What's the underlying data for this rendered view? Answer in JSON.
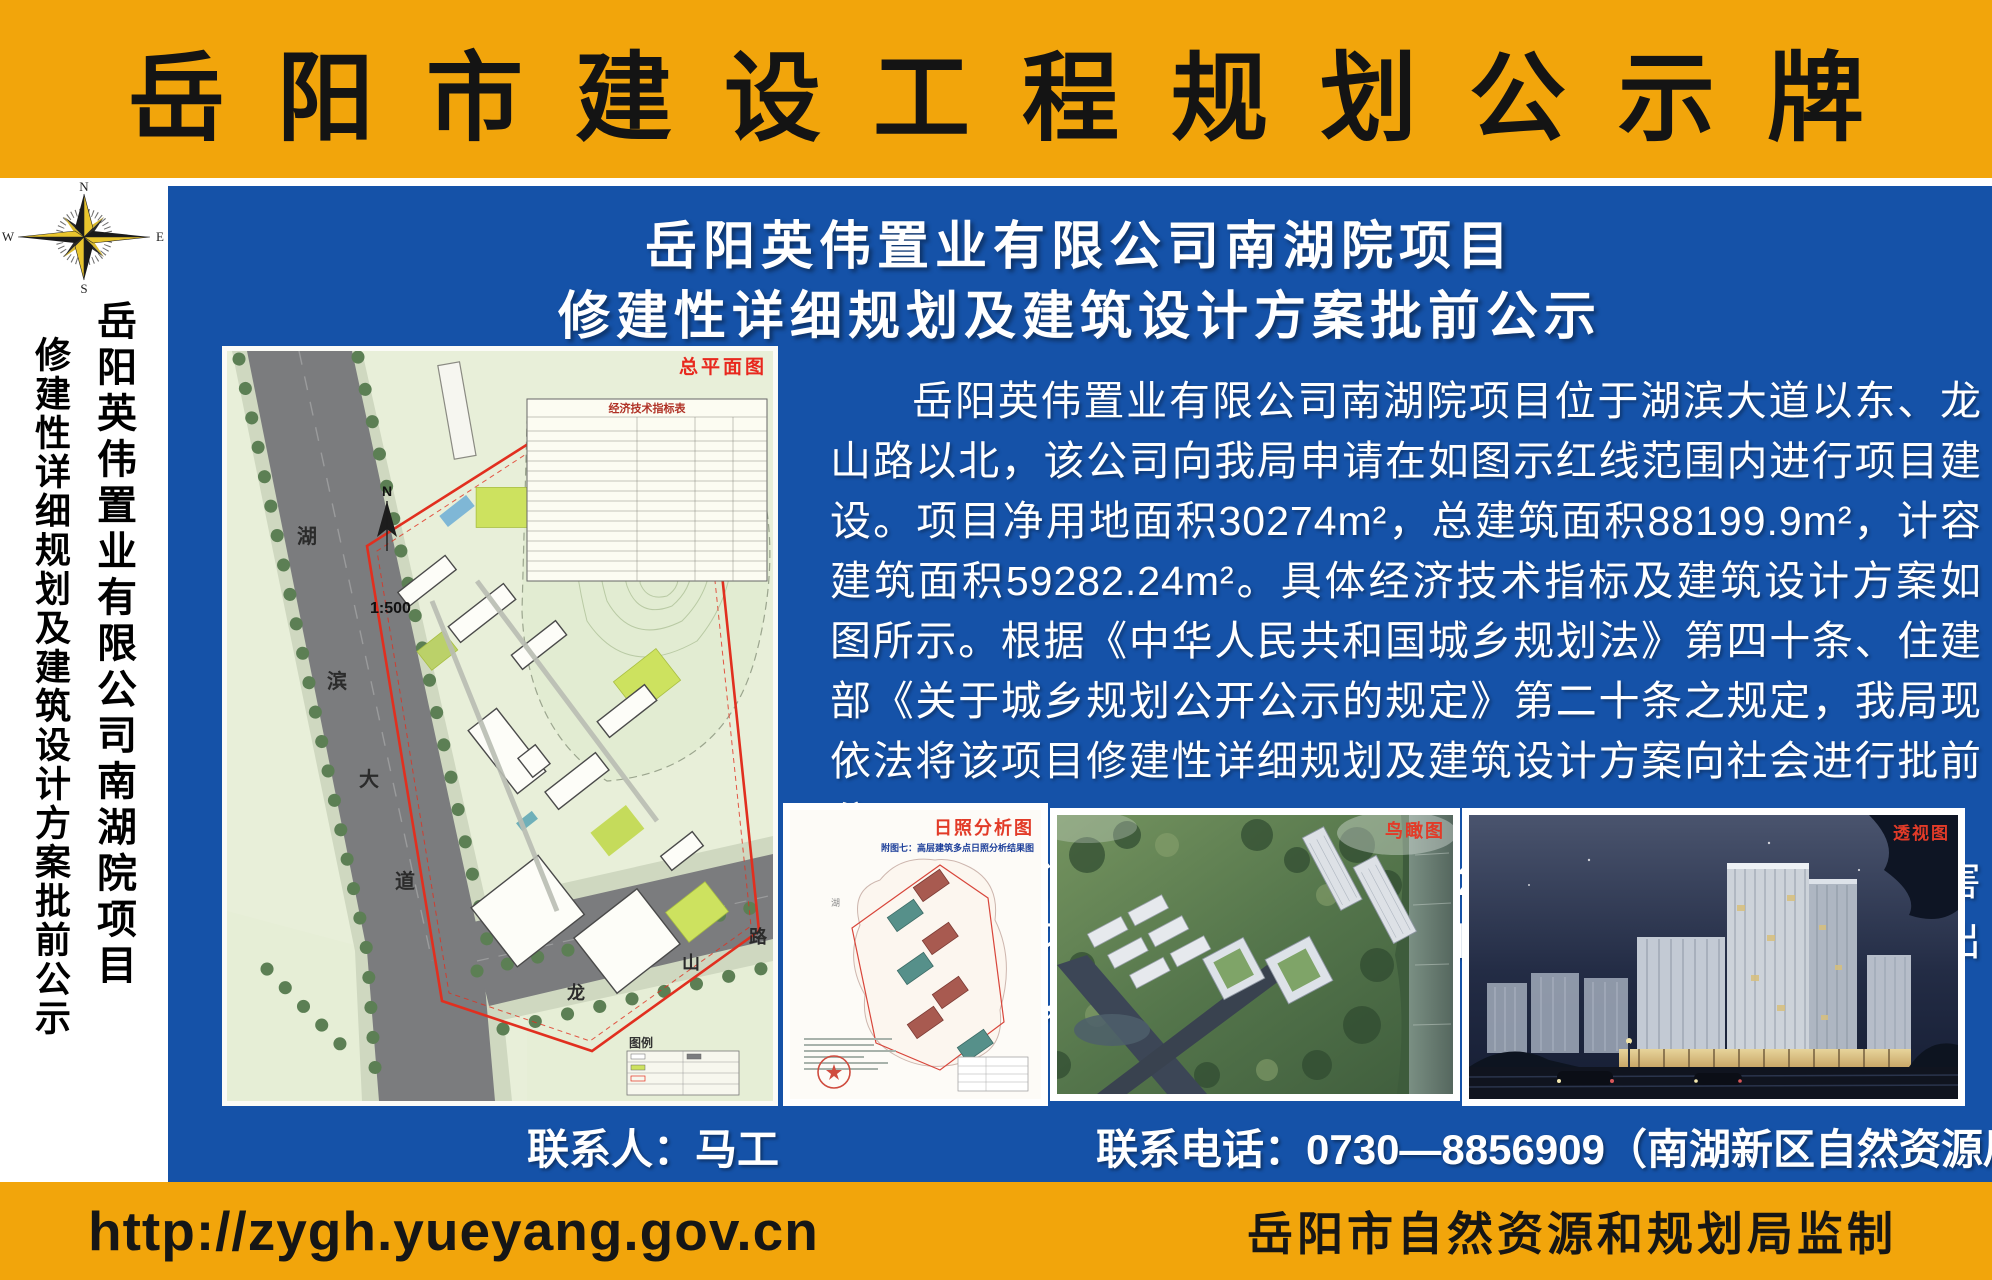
{
  "colors": {
    "orange": "#F2A50B",
    "blue": "#1552A8",
    "red_label": "#E8391A",
    "map_bg": "#E8EFD9"
  },
  "top_banner": {
    "title": "岳阳市建设工程规划公示牌"
  },
  "sidebar": {
    "compass": {
      "n": "N",
      "s": "S",
      "e": "E",
      "w": "W"
    },
    "project_line": "岳阳英伟置业有限公司南湖院项目",
    "notice_line": "修建性详细规划及建筑设计方案批前公示"
  },
  "main": {
    "title_line1": "岳阳英伟置业有限公司南湖院项目",
    "title_line2": "修建性详细规划及建筑设计方案批前公示",
    "paragraph1": "岳阳英伟置业有限公司南湖院项目位于湖滨大道以东、龙山路以北，该公司向我局申请在如图示红线范围内进行项目建设。项目净用地面积30274m²，总建筑面积88199.9m²，计容建筑面积59282.24m²。具体经济技术指标及建筑设计方案如图所示。根据《中华人民共和国城乡规划法》第四十条、住建部《关于城乡规划公开公示的规定》第二十条之规定，我局现依法将该项目修建性详细规划及建筑设计方案向社会进行批前公示。",
    "paragraph2": "公示时间为2025年11月6日至2025年11月14日。相关利害关系人若有不同意见，请在公示日期内以书面形式向我局提出意见或建议，逾期我局不再受理。",
    "site_plan": {
      "label": "总平面图",
      "scale": "1:500",
      "table_title": "经济技术指标表",
      "legend_label": "图例",
      "road_hubin_chars": [
        "湖",
        "滨",
        "大",
        "道"
      ],
      "road_longshan_chars": [
        "龙",
        "山",
        "路"
      ]
    },
    "thumbs": {
      "sunshine_label": "日照分析图",
      "sunshine_caption": "附图七：高层建筑多点日照分析结果图",
      "aerial_label": "鸟瞰图",
      "perspective_label": "透视图"
    },
    "contact_person": "联系人：马工",
    "contact_phone": "联系电话：0730—8856909（南湖新区自然资源局）"
  },
  "bottom_banner": {
    "url": "http://zygh.yueyang.gov.cn",
    "credit": "岳阳市自然资源和规划局监制"
  }
}
